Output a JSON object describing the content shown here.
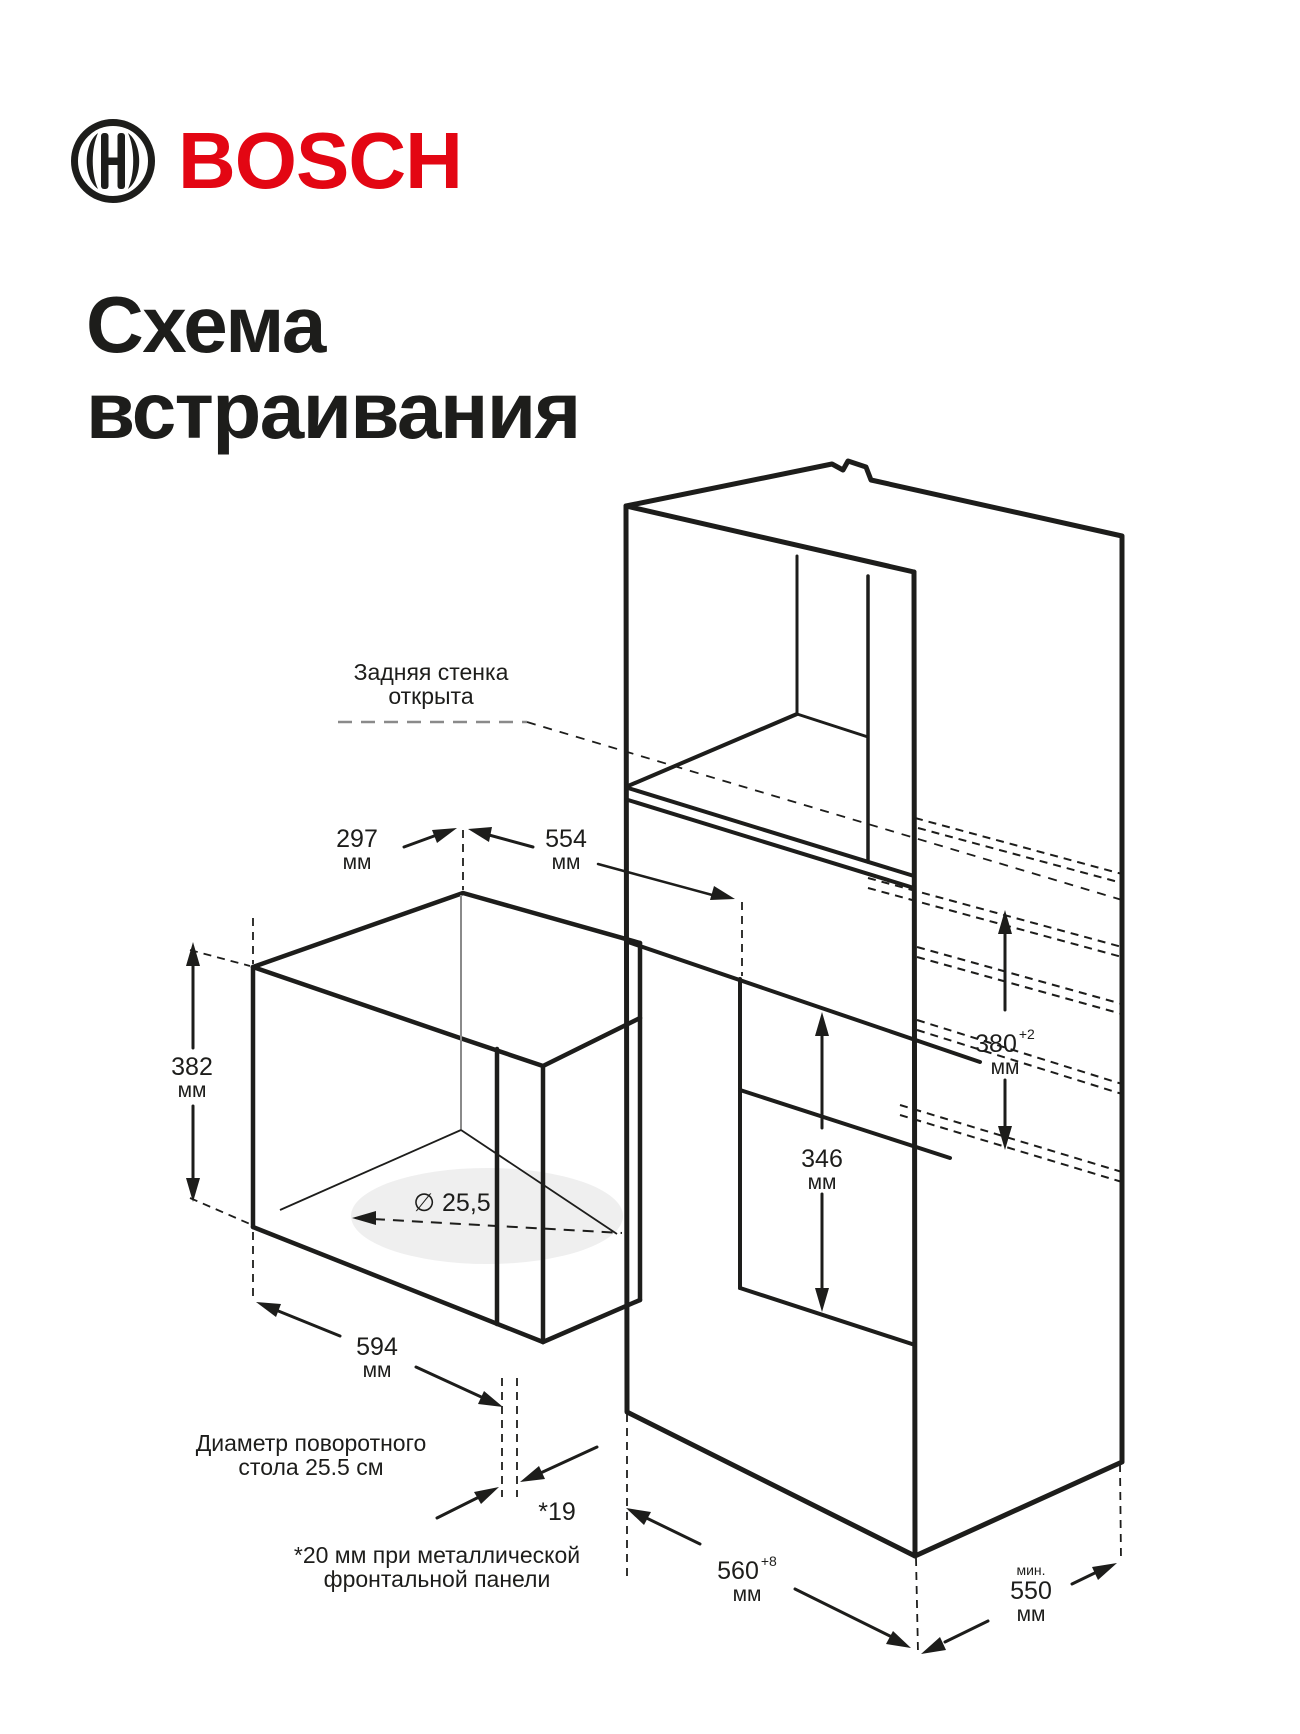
{
  "page": {
    "background": "#ffffff"
  },
  "logo": {
    "brand": "BOSCH",
    "symbol": "bosch-armature-icon"
  },
  "title": {
    "line1": "Схема",
    "line2": "встраивания"
  },
  "annotations": {
    "back_wall": {
      "line1": "Задняя стенка",
      "line2": "открыта"
    },
    "turntable": {
      "line1": "Диаметр поворотного",
      "line2": "стола 25.5 см"
    },
    "front_panel": {
      "line1": "*20 мм при металлической",
      "line2": "фронтальной панели"
    }
  },
  "dimensions": {
    "top_left": {
      "value": "297",
      "unit": "мм"
    },
    "top_depth": {
      "value": "554",
      "unit": "мм"
    },
    "appliance_height": {
      "value": "382",
      "unit": "мм"
    },
    "niche_front_height": {
      "value": "346",
      "unit": "мм"
    },
    "niche_height": {
      "value": "380",
      "tolerance": "+2",
      "unit": "мм"
    },
    "appliance_width": {
      "value": "594",
      "unit": "мм"
    },
    "protrusion": {
      "value": "*19"
    },
    "niche_depth": {
      "value": "560",
      "tolerance": "+8",
      "unit": "мм"
    },
    "cabinet_depth": {
      "prefix": "мин.",
      "value": "550",
      "unit": "мм"
    },
    "turntable_diameter": {
      "value": "∅ 25,5"
    }
  },
  "colors": {
    "brand_red": "#e30613",
    "line_black": "#1d1d1b",
    "turntable_fill": "#efefef",
    "dash_gray": "#8a8a8a"
  }
}
